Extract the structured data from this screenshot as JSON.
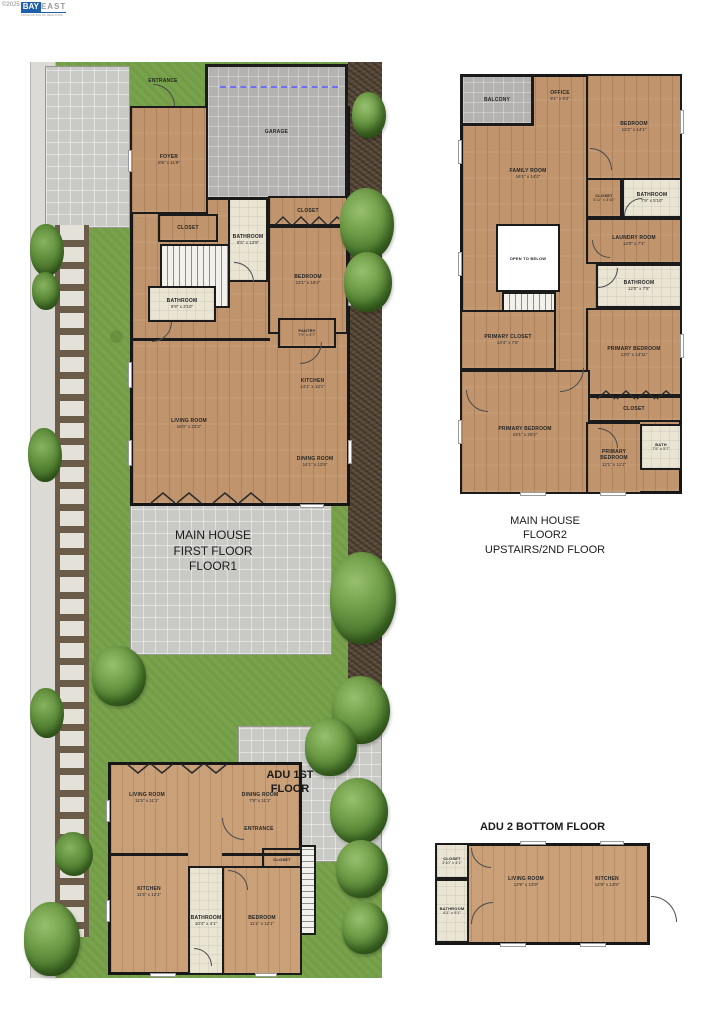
{
  "watermark": {
    "copyright": "©2025",
    "brand_bay": "BAY",
    "brand_east": "EAST",
    "tagline": "ASSOCIATION OF REALTORS"
  },
  "site": {
    "floor1_title": [
      "MAIN HOUSE",
      "FIRST FLOOR",
      "FLOOR1"
    ],
    "floor2_title": [
      "MAIN HOUSE",
      "FLOOR2",
      "UPSTAIRS/2ND FLOOR"
    ],
    "adu1_title": [
      "ADU 1ST",
      "FLOOR"
    ],
    "adu2_title": "ADU 2 BOTTOM FLOOR"
  },
  "floor1": {
    "entrance": "ENTRANCE",
    "garage": {
      "label": "GARAGE"
    },
    "foyer": {
      "label": "FOYER",
      "dims": "8'6\" x 11'9\""
    },
    "closet_left": {
      "label": "CLOSET"
    },
    "bathroom_center": {
      "label": "BATHROOM",
      "dims": "5'5\" x 13'9\""
    },
    "closet_right": {
      "label": "CLOSET"
    },
    "bedroom": {
      "label": "BEDROOM",
      "dims": "13'1\" x 16'2\""
    },
    "bathroom_left": {
      "label": "BATHROOM",
      "dims": "9'9\" x 3'10\""
    },
    "pantry": {
      "label": "PANTRY",
      "dims": "7'9\" x 4'7\""
    },
    "kitchen": {
      "label": "KITCHEN",
      "dims": "14'1\" x 13'1\""
    },
    "living_room": {
      "label": "LIVING ROOM",
      "dims": "16'0\" x 23'3\""
    },
    "dining_room": {
      "label": "DINING ROOM",
      "dims": "14'1\" x 12'9\""
    }
  },
  "floor2": {
    "balcony": {
      "label": "BALCONY"
    },
    "office": {
      "label": "OFFICE",
      "dims": "9'1\" x 9'2\""
    },
    "bedroom": {
      "label": "BEDROOM",
      "dims": "12'2\" x 14'1\""
    },
    "family_room": {
      "label": "FAMILY ROOM",
      "dims": "16'1\" x 14'2\""
    },
    "closet_small": {
      "label": "CLOSET",
      "dims": "5'11\" x 3'10\""
    },
    "bathroom_top": {
      "label": "BATHROOM",
      "dims": "7'9\" x 5'10\""
    },
    "laundry_room": {
      "label": "LAUNDRY ROOM",
      "dims": "12'0\" x 7'1\""
    },
    "open_to_below": {
      "label": "OPEN TO BELOW"
    },
    "bathroom_mid": {
      "label": "BATHROOM",
      "dims": "12'0\" x 7'5\""
    },
    "primary_closet": {
      "label": "PRIMARY CLOSET",
      "dims": "13'4\" x 7'5\""
    },
    "primary_bedroom_right": {
      "label": "PRIMARY BEDROOM",
      "dims": "13'0\" x 13'11\""
    },
    "closet_wide": {
      "label": "CLOSET"
    },
    "primary_bedroom_large": {
      "label": "PRIMARY BEDROOM",
      "dims": "19'1\" x 20'2\""
    },
    "bath": {
      "label": "BATH",
      "dims": "7'5\" x 5'7\""
    },
    "primary_bedroom_bottom": {
      "label": "PRIMARY BEDROOM",
      "dims": "12'1\" x 11'1\""
    }
  },
  "adu1": {
    "entrance": "ENTRANCE",
    "living_room": {
      "label": "LIVING ROOM",
      "dims": "11'5\" x 11'1\""
    },
    "dining_room": {
      "label": "DINING ROOM",
      "dims": "7'9\" x 11'1\""
    },
    "closet": {
      "label": "CLOSET"
    },
    "kitchen": {
      "label": "KITCHEN",
      "dims": "11'5\" x 12'1\""
    },
    "bathroom": {
      "label": "BATHROOM",
      "dims": "10'4\" x 4'1\""
    },
    "bedroom": {
      "label": "BEDROOM",
      "dims": "11'1\" x 12'1\""
    }
  },
  "adu2": {
    "closet": {
      "label": "CLOSET",
      "dims": "3'10\" x 4'1\""
    },
    "bathroom": {
      "label": "BATHROOM",
      "dims": "6'1\" x 9'1\""
    },
    "living_room": {
      "label": "LIVING ROOM",
      "dims": "13'9\" x 13'9\""
    },
    "kitchen": {
      "label": "KITCHEN",
      "dims": "12'9\" x 13'9\""
    }
  },
  "colors": {
    "wood": "#c0946c",
    "tile": "#eae4d3",
    "concrete": "#c9c9c6",
    "grass": "#79a24c",
    "wall": "#1b1b1b",
    "garage_dash": "#6f6ff0",
    "tree": "#4d7b2f"
  }
}
